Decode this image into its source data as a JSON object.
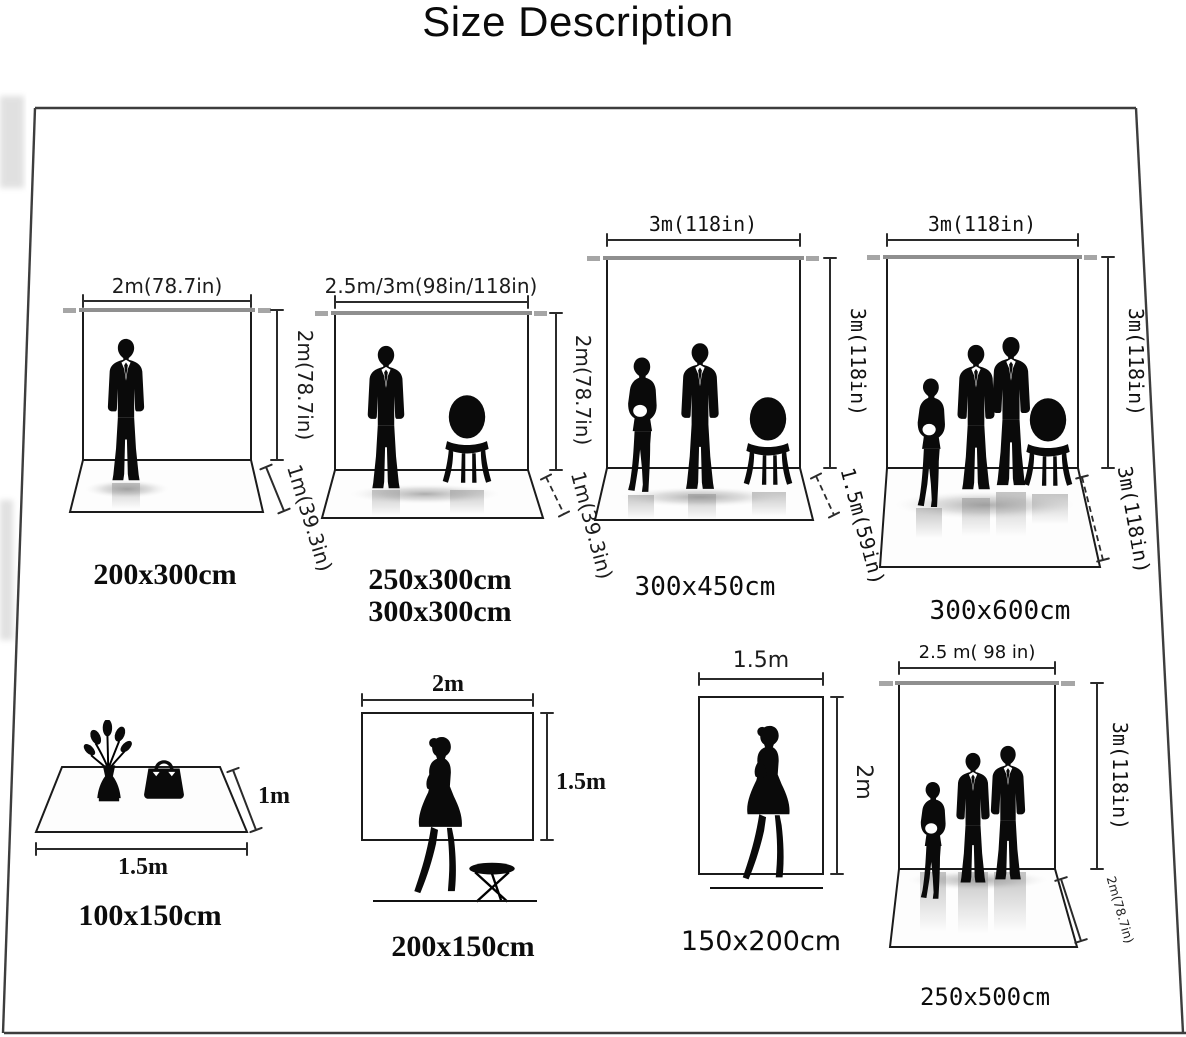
{
  "title": "Size Description",
  "colors": {
    "line": "#2b2b2b",
    "crossbar": "#8f8f8f",
    "silhouette": "#0a0a0a",
    "background": "#ffffff"
  },
  "panels": [
    {
      "id": "200x300",
      "size_label": "200x300cm",
      "width_label": "2m(78.7in)",
      "height_label": "2m(78.7in)",
      "floor_label": "1m(39.3in)",
      "figures": [
        "man"
      ]
    },
    {
      "id": "250x300-300x300",
      "size_label": "250x300cm",
      "size_label2": "300x300cm",
      "width_label": "2.5m/3m(98in/118in)",
      "height_label": "2m(78.7in)",
      "floor_label": "1m(39.3in)",
      "figures": [
        "man",
        "chair"
      ]
    },
    {
      "id": "300x450",
      "size_label": "300x450cm",
      "width_label": "3m(118in)",
      "height_label": "3m(118in)",
      "floor_label": "1.5m(59in)",
      "figures": [
        "woman",
        "man",
        "chair"
      ]
    },
    {
      "id": "300x600",
      "size_label": "300x600cm",
      "width_label": "3m(118in)",
      "height_label": "3m(118in)",
      "floor_label": "3m(118in)",
      "figures": [
        "woman",
        "man",
        "man",
        "chair"
      ]
    },
    {
      "id": "100x150",
      "size_label": "100x150cm",
      "width_label": "1.5m",
      "height_label": "1m",
      "figures": [
        "vase-flowers",
        "handbag"
      ]
    },
    {
      "id": "200x150",
      "size_label": "200x150cm",
      "width_label": "2m",
      "height_label": "1.5m",
      "figures": [
        "woman",
        "stool"
      ]
    },
    {
      "id": "150x200",
      "size_label": "150x200cm",
      "width_label": "1.5m",
      "height_label": "2m",
      "figures": [
        "woman"
      ]
    },
    {
      "id": "250x500",
      "size_label": "250x500cm",
      "width_label": "2.5 m( 98 in)",
      "height_label": "3m(118in)",
      "floor_label": "2m(78.7in)",
      "figures": [
        "woman",
        "man",
        "man"
      ]
    }
  ]
}
